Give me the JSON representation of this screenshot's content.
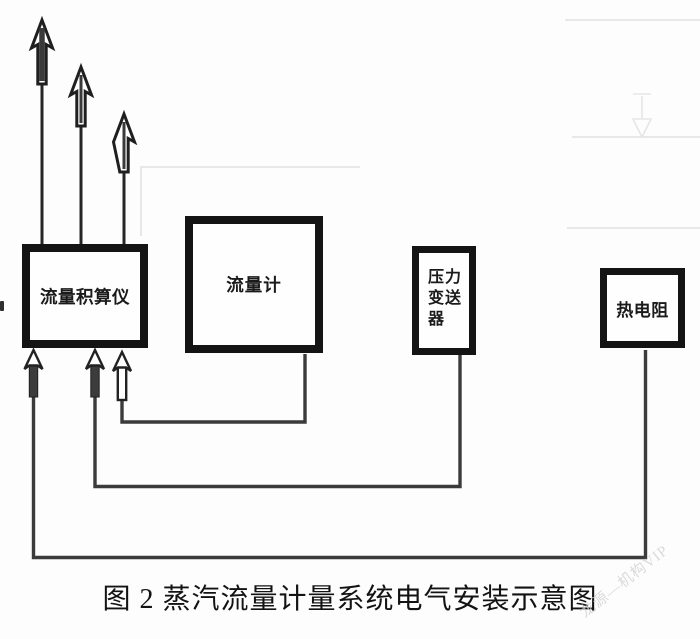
{
  "figure": {
    "caption": "图 2 蒸汽流量计量系统电气安装示意图",
    "watermark": "龙源—机构VIP"
  },
  "boxes": {
    "totalizer": {
      "label": "流量积算仪"
    },
    "flowmeter": {
      "label": "流量计"
    },
    "pressure": {
      "line1": "压力",
      "line2": "变送",
      "line3": "器",
      "full_label": "压力变送器"
    },
    "rtd": {
      "label": "热电阻"
    }
  },
  "colors": {
    "box_border": "#141414",
    "wire": "#3b3b3b",
    "arrow_outline": "#1f1f1f",
    "arrow_fill_dark": "#3c3c3c",
    "ghost": "#e8e8e8",
    "text": "#1b1b1b",
    "background": "#fdfdfd"
  }
}
